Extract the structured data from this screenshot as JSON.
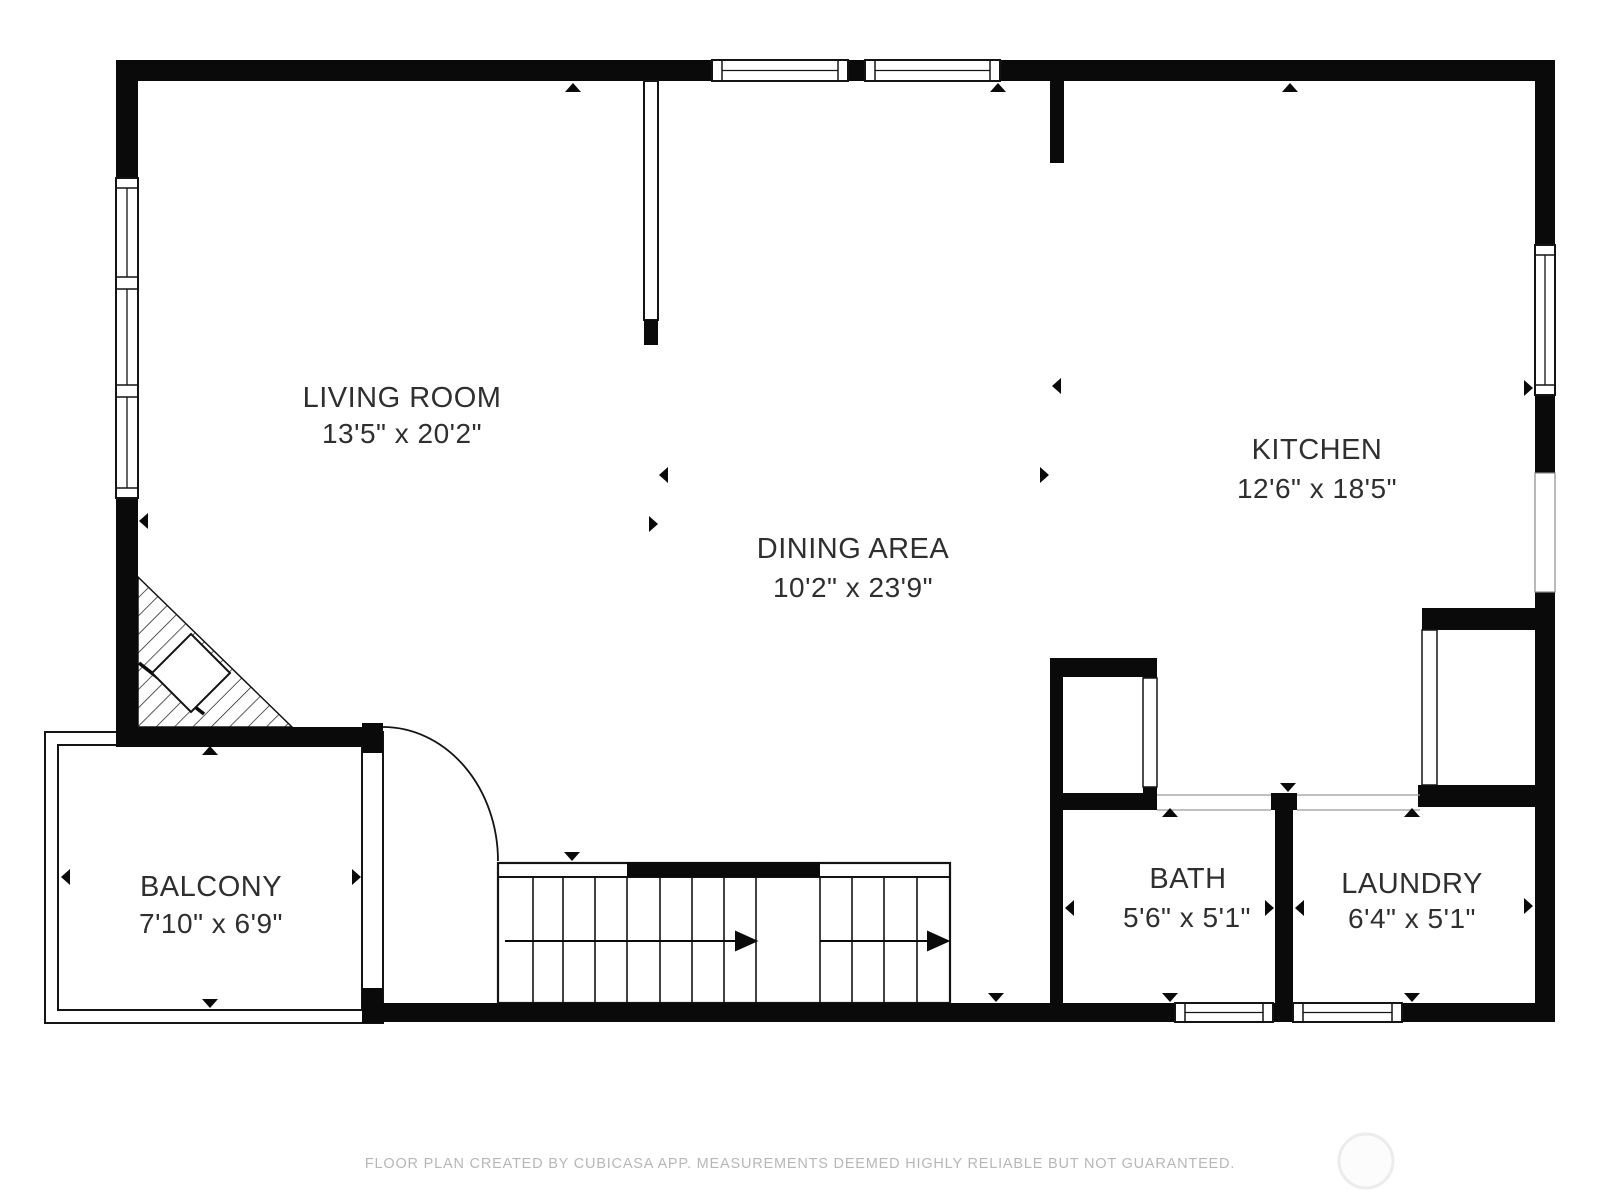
{
  "page": {
    "background_color": "#ffffff",
    "footer_text": "FLOOR PLAN CREATED BY CUBICASA APP. MEASUREMENTS DEEMED HIGHLY RELIABLE BUT NOT GUARANTEED."
  },
  "colors": {
    "wall": "#0a0a0a",
    "room_label": "#2f2f2f",
    "footer": "#b7b7b7",
    "watermark_stroke": "#ececec",
    "watermark_fill": "#fcfcfc"
  },
  "rooms": {
    "living_room": {
      "name": "LIVING ROOM",
      "dimensions": "13'5\" x 20'2\""
    },
    "dining_area": {
      "name": "DINING AREA",
      "dimensions": "10'2\" x 23'9\""
    },
    "kitchen": {
      "name": "KITCHEN",
      "dimensions": "12'6\" x 18'5\""
    },
    "balcony": {
      "name": "BALCONY",
      "dimensions": "7'10\" x 6'9\""
    },
    "bath": {
      "name": "BATH",
      "dimensions": "5'6\" x 5'1\""
    },
    "laundry": {
      "name": "LAUNDRY",
      "dimensions": "6'4\" x 5'1\""
    }
  }
}
